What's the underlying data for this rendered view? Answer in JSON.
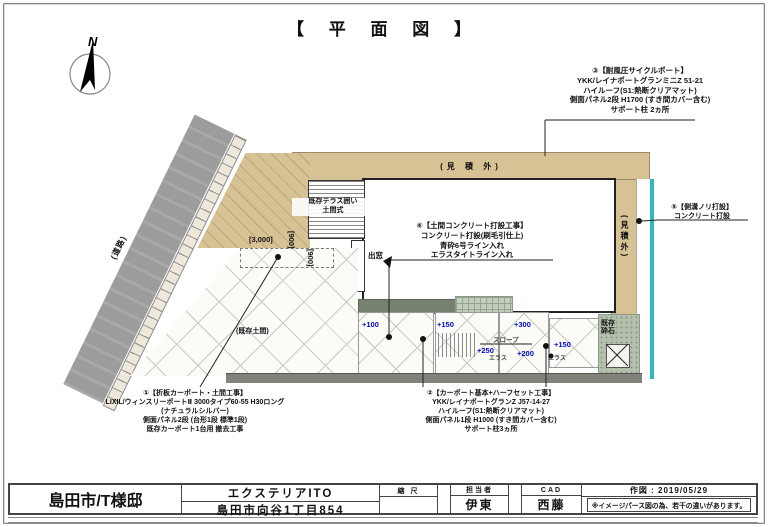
{
  "title": "【 平 面 図 】",
  "compass": {
    "north_label": "N"
  },
  "plan": {
    "road_label": "(道路)",
    "outside_estimate_top": "(見 積 外)",
    "outside_estimate_right": "(見積外)",
    "terrace_line1": "既存テラス囲い",
    "terrace_line2": "土間式",
    "bay_window": "出窓",
    "existing_floor": "(既存土間)",
    "gravel_line1": "既存",
    "gravel_line2": "砕石",
    "slope": "スロープ",
    "elas": "エラス",
    "dim_3000": "[3,000]",
    "dim_900": "[900]",
    "levels": [
      "+100",
      "+150",
      "+250",
      "+300",
      "+200",
      "+150"
    ]
  },
  "annotations": {
    "no1": {
      "lines": [
        "①【折板カーポート・土間工事】",
        "LIXIL/ウィンスリーポートⅡ 3000タイプ60-55 H30ロング",
        "(ナチュラルシルバー)",
        "側面パネル2段 (台形1段 標準1段)",
        "既存カーポート1台用 撤去工事"
      ]
    },
    "no2": {
      "lines": [
        "②【カーポート基本+ハーフセット工事】",
        "YKK/レイナポートグランZ J57-14-27",
        "ハイルーフ(S1:熱断クリアマット)",
        "側面パネル1段 H1000 (すき間カバー含む)",
        "サポート柱3ヵ所"
      ]
    },
    "no3": {
      "lines": [
        "③【耐風圧サイクルポート】",
        "YKK/レイナポートグランミニZ 51-21",
        "ハイルーフ(S1:熱断クリアマット)",
        "側面パネル2段 H1700 (すき間カバー含む)",
        "サポート柱 2ヵ所"
      ]
    },
    "no4": {
      "lines": [
        "④【土間コンクリート打設工事】",
        "コンクリート打設(刷毛引仕上)",
        "青砕6号ライン入れ",
        "エラスタイトライン入れ"
      ]
    },
    "no5": {
      "lines": [
        "⑤【側溝ノリ打設】",
        "コンクリート打設"
      ]
    }
  },
  "titleblock": {
    "client": "島田市/T様邸",
    "company": "エクステリアITO",
    "address": "島田市向谷1丁目854",
    "scale_label": "縮 尺",
    "staff_label": "担当者",
    "staff_value": "伊東",
    "cad_label": "CAD",
    "cad_value": "西藤",
    "date_label": "作図 : 2019/05/29",
    "note": "※イメージパース図の為、若干の違いがあります。"
  },
  "colors": {
    "level_blue": "#0008c8",
    "tan": "#d7c295",
    "road_gray": "#9c9c9c",
    "teal": "#2fb7bc",
    "gravel_green": "#b4bfae"
  }
}
